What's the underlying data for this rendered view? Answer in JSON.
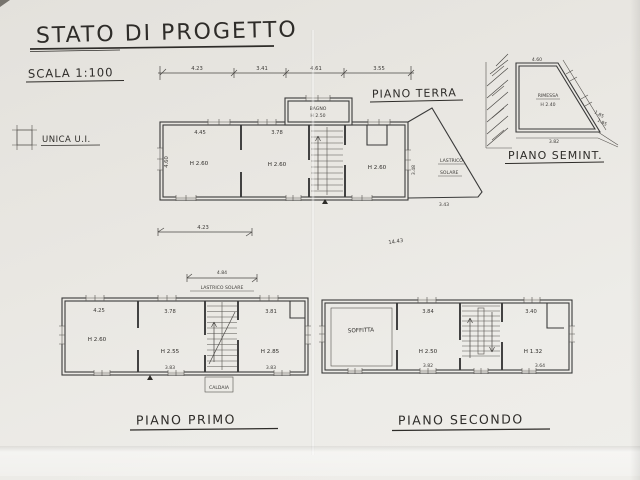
{
  "header": {
    "title": "STATO DI PROGETTO",
    "scale": "SCALA 1:100",
    "legend": "UNICA U.I."
  },
  "terra": {
    "label": "PIANO TERRA",
    "dims": {
      "chain": [
        "4.23",
        "3.41",
        "4.61",
        "3.55"
      ],
      "left_v": "4.60",
      "room1": "4.45",
      "room2": "3.78",
      "below": "4.23",
      "total": "14.43"
    },
    "rooms": {
      "room1_h": "H 2.60",
      "room2_h": "H 2.60",
      "room3_h": "H 2.60"
    },
    "bagno": {
      "name": "BAGNO",
      "h": "H 2.50"
    },
    "lastrico": {
      "line1": "LASTRICO",
      "line2": "SOLARE",
      "side": "3.48",
      "bottom": "3.43"
    }
  },
  "semint": {
    "label": "PIANO SEMINT.",
    "top_dim": "4.60",
    "room_name": "RIMESSA",
    "room_h": "H 2.40",
    "bottom_dim": "3.82",
    "slant_dim1": "1.85",
    "slant_dim2": "1.95"
  },
  "primo": {
    "label": "PIANO PRIMO",
    "lastrico": "LASTRICO SOLARE",
    "lastrico_dim": "4.84",
    "room1_dim": "4.25",
    "room1_h": "H 2.60",
    "room2_dim": "3.78",
    "room2_h": "H 2.55",
    "room3_dim": "3.81",
    "room3_h": "H 2.85",
    "room2_bottom": "3.83",
    "room3_bottom": "3.83",
    "caldaia": "CALDAIA"
  },
  "secondo": {
    "label": "PIANO SECONDO",
    "room1_name": "SOFFITTA",
    "room2_dim": "3.84",
    "room2_h": "H 2.50",
    "room3_dim": "3.40",
    "room3_h": "H 1.32",
    "room2_bottom": "3.82",
    "room3_bottom": "3.64"
  }
}
